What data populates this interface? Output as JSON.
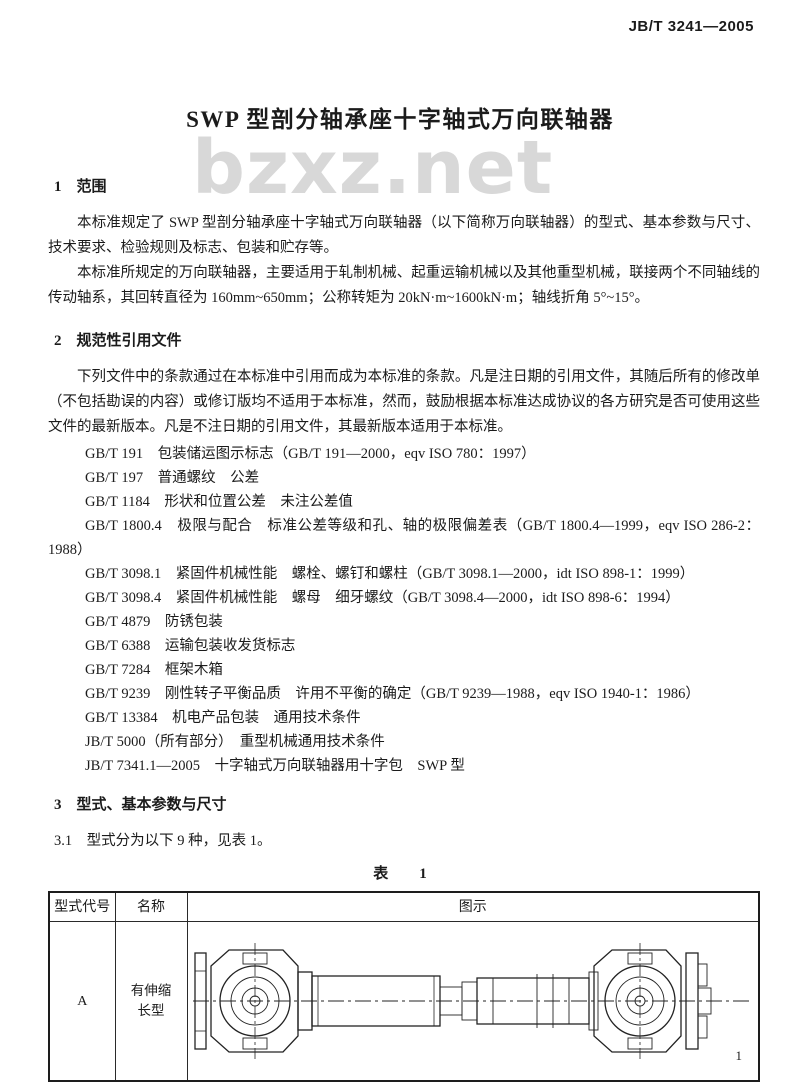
{
  "page": {
    "doc_code": "JB/T 3241—2005",
    "title": "SWP 型剖分轴承座十字轴式万向联轴器",
    "watermark": "bzxz.net",
    "page_number": "1"
  },
  "section1": {
    "heading": "1　范围",
    "para1": "本标准规定了 SWP 型剖分轴承座十字轴式万向联轴器（以下简称万向联轴器）的型式、基本参数与尺寸、技术要求、检验规则及标志、包装和贮存等。",
    "para2": "本标准所规定的万向联轴器，主要适用于轧制机械、起重运输机械以及其他重型机械，联接两个不同轴线的传动轴系，其回转直径为 160mm~650mm；公称转矩为 20kN·m~1600kN·m；轴线折角 5°~15°。"
  },
  "section2": {
    "heading": "2　规范性引用文件",
    "para": "下列文件中的条款通过在本标准中引用而成为本标准的条款。凡是注日期的引用文件，其随后所有的修改单（不包括勘误的内容）或修订版均不适用于本标准，然而，鼓励根据本标准达成协议的各方研究是否可使用这些文件的最新版本。凡是不注日期的引用文件，其最新版本适用于本标准。",
    "references": [
      "GB/T 191　包装储运图示标志（GB/T 191—2000，eqv ISO 780：1997）",
      "GB/T 197　普通螺纹　公差",
      "GB/T 1184　形状和位置公差　未注公差值",
      "GB/T 1800.4　极限与配合　标准公差等级和孔、轴的极限偏差表（GB/T 1800.4—1999，eqv ISO 286-2：1988）",
      "GB/T 3098.1　紧固件机械性能　螺栓、螺钉和螺柱（GB/T 3098.1—2000，idt ISO 898-1：1999）",
      "GB/T 3098.4　紧固件机械性能　螺母　细牙螺纹（GB/T 3098.4—2000，idt ISO 898-6：1994）",
      "GB/T 4879　防锈包装",
      "GB/T 6388　运输包装收发货标志",
      "GB/T 7284　框架木箱",
      "GB/T 9239　刚性转子平衡品质　许用不平衡的确定（GB/T 9239—1988，eqv ISO 1940-1：1986）",
      "GB/T 13384　机电产品包装　通用技术条件",
      "JB/T 5000（所有部分）　重型机械通用技术条件",
      "JB/T 7341.1—2005　十字轴式万向联轴器用十字包　SWP 型"
    ]
  },
  "section3": {
    "heading": "3　型式、基本参数与尺寸",
    "clause_3_1": "3.1　型式分为以下 9 种，见表 1。",
    "table_caption": "表　1",
    "table": {
      "headers": [
        "型式代号",
        "名称",
        "图示"
      ],
      "rows": [
        {
          "code": "A",
          "name_line1": "有伸缩",
          "name_line2": "长型"
        }
      ]
    }
  }
}
